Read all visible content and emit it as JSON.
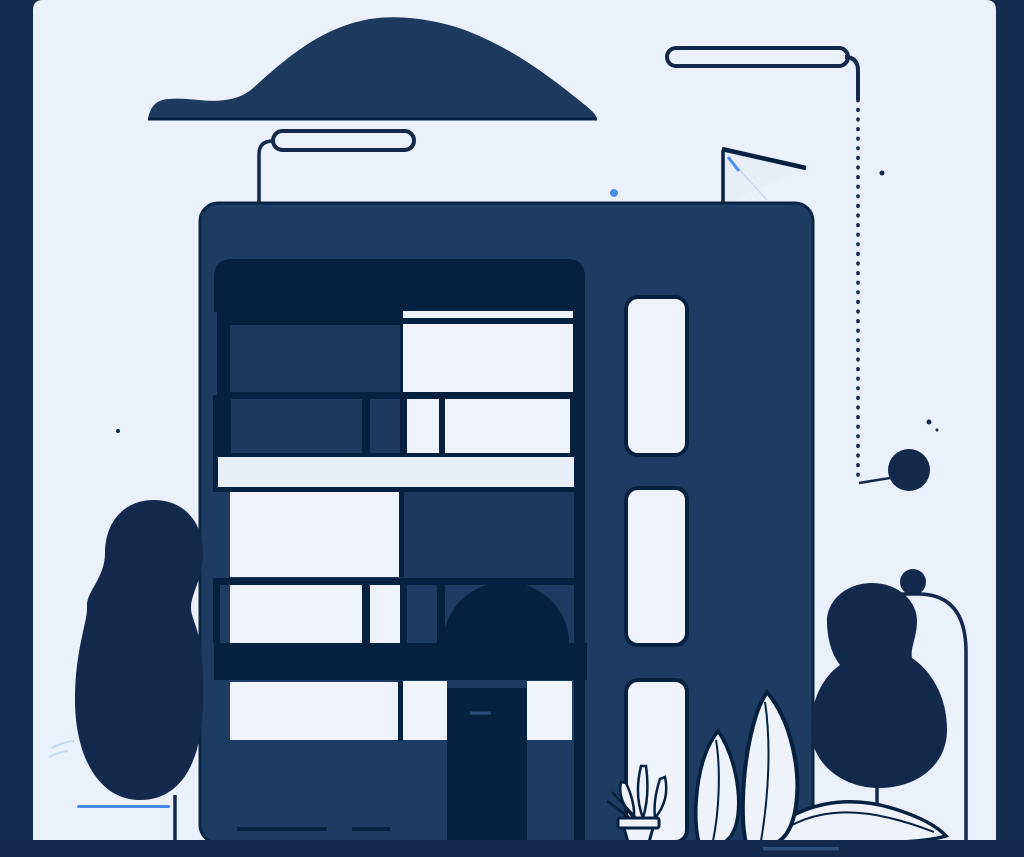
{
  "palette": {
    "frame": "#142C50",
    "ground": "#132A4E",
    "ground_accent": "#2B4C78",
    "canvas_bg": "#EBF1FC",
    "ink": "#06213F",
    "deep": "#12294B",
    "outline": "#0B2545",
    "body": "#1E3B63",
    "glass_dark": "#1E3860",
    "window_light": "#EEF3FD",
    "band_light": "#E9EFFA",
    "leaf_fill": "#EDF2FB",
    "cloud": "#1D395D",
    "accent_blue": "#4E8CF0",
    "ground_line_blue": "#4B8BEE",
    "faint_blue": "#A8C4E8",
    "handle": "#2E4D79",
    "flag_fill": "#E7EEFA",
    "crease": "#C9D6EE"
  },
  "scene": {
    "type": "flat vector illustration, no text",
    "elements": [
      "dark navy cloud over roof",
      "street lamp left with curved pole reaching the roof",
      "street lamp right with pole turning into dotted cable ending at a ball",
      "pennant flag on roof with small blue stroke",
      "four-storey apartment building with dark awning, two balconies, white balcony band, dome awning, entrance door",
      "side tower with three tall rounded windows",
      "blob-shaped tree left with thin trunk",
      "blob-shaped tree right with thin trunk and arch gate behind",
      "potted plant and large outlined leaves at the entrance",
      "blue ground line near left tree, small scattered dots, one bright blue dot"
    ],
    "counts": {
      "street_lamps": 2,
      "balconies": 2,
      "tower_windows": 3,
      "trees": 2
    }
  }
}
